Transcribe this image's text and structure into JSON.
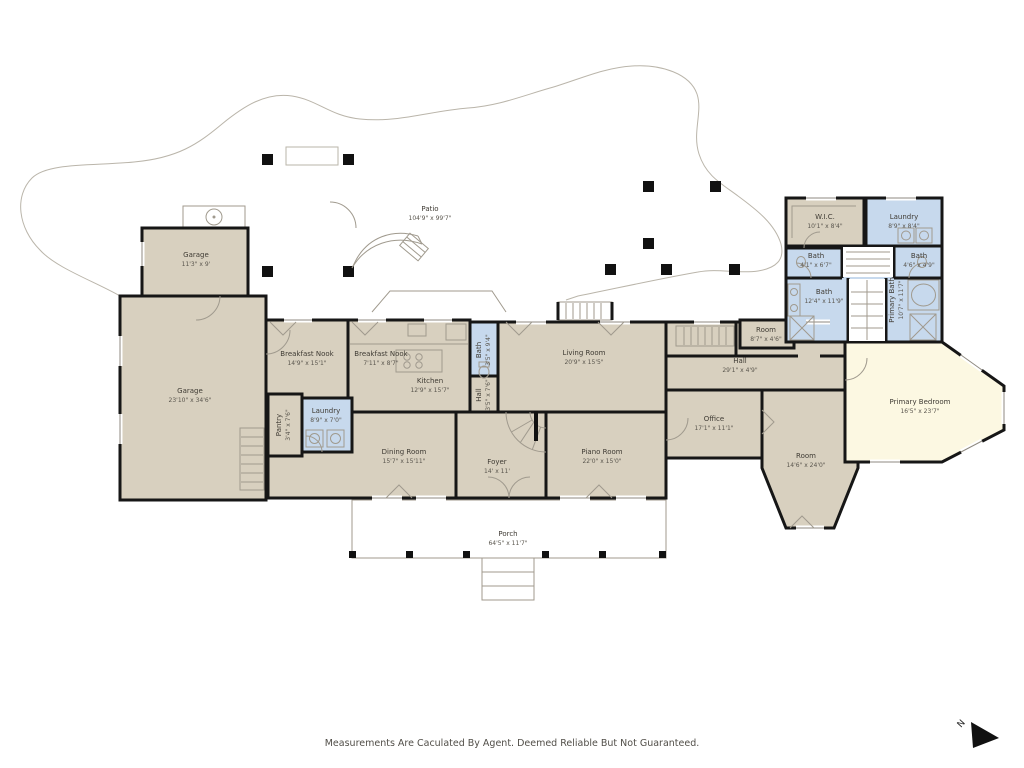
{
  "plan": {
    "disclaimer": "Measurements Are Caculated By Agent. Deemed Reliable But Not Guaranteed.",
    "north_label": "N",
    "colors": {
      "room_tan": "#d8d0bf",
      "room_blue": "#c7d9ed",
      "room_cream": "#fcf8e2",
      "wall": "#161616",
      "thin_line": "#a09a8e",
      "text": "#3f3b34"
    }
  },
  "rooms": [
    {
      "name": "Garage",
      "dims": "11'3\" x 9'"
    },
    {
      "name": "Garage",
      "dims": "23'10\" x 34'6\""
    },
    {
      "name": "Breakfast Nook",
      "dims": "14'9\" x 15'1\""
    },
    {
      "name": "Breakfast Nook",
      "dims": "7'11\" x 8'7\""
    },
    {
      "name": "Kitchen",
      "dims": "12'9\" x 15'7\""
    },
    {
      "name": "Bath",
      "dims": "3'5\" x 9'4\""
    },
    {
      "name": "Living Room",
      "dims": "20'9\" x 15'5\""
    },
    {
      "name": "Pantry",
      "dims": "3'4\" x 7'6\""
    },
    {
      "name": "Laundry",
      "dims": "8'9\" x 7'0\""
    },
    {
      "name": "Dining Room",
      "dims": "15'7\" x 15'11\""
    },
    {
      "name": "Foyer",
      "dims": "14' x 11'"
    },
    {
      "name": "Piano Room",
      "dims": "22'0\" x 15'0\""
    },
    {
      "name": "Hall",
      "dims": "29'1\" x 4'9\""
    },
    {
      "name": "Room",
      "dims": "8'7\" x 4'6\""
    },
    {
      "name": "Office",
      "dims": "17'1\" x 11'1\""
    },
    {
      "name": "Room",
      "dims": "14'6\" x 24'0\""
    },
    {
      "name": "Primary Bedroom",
      "dims": "16'5\" x 23'7\""
    },
    {
      "name": "W.I.C.",
      "dims": "10'1\" x 8'4\""
    },
    {
      "name": "Laundry",
      "dims": "8'9\" x 8'4\""
    },
    {
      "name": "Bath",
      "dims": "4'1\" x 6'7\""
    },
    {
      "name": "Bath",
      "dims": "4'6\" x 4'9\""
    },
    {
      "name": "Bath",
      "dims": "12'4\" x 11'9\""
    },
    {
      "name": "Primary Bath",
      "dims": "10'7\" x 11'7\""
    },
    {
      "name": "Patio",
      "dims": "104'9\" x 99'7\""
    },
    {
      "name": "Porch",
      "dims": "64'5\" x 11'7\""
    },
    {
      "name": "Hall",
      "dims": "3'5\" x 7'6\""
    }
  ]
}
